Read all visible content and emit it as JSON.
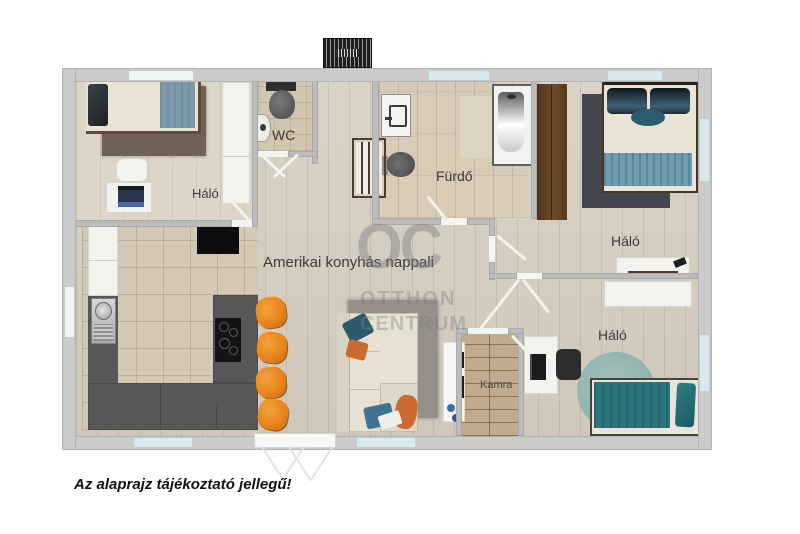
{
  "rooms": {
    "bedroom_top_left": {
      "label": "Háló"
    },
    "wc": {
      "label": "WC"
    },
    "bathroom": {
      "label": "Fürdő"
    },
    "bedroom_top_right": {
      "label": "Háló"
    },
    "living": {
      "label": "Amerikai konyhás nappali"
    },
    "pantry": {
      "label": "Kamra"
    },
    "bedroom_bottom_right": {
      "label": "Háló"
    }
  },
  "watermark": {
    "monogram": "OC",
    "name_line1": "OTTHON",
    "name_line2": "CENTRUM"
  },
  "disclaimer": "Az alaprajz tájékoztató jellegű!",
  "colors": {
    "outer_wall": "#cbcbcb",
    "wood_floor": "#d7d0c2",
    "kitchen_tile": "#d4c8b5",
    "window_blue": "#d9e9ec",
    "stool_orange": "#e8851c",
    "bed_teal": "#2e767d",
    "blanket_blue": "#7e99a9",
    "counter_gray": "#5a5a5a"
  }
}
